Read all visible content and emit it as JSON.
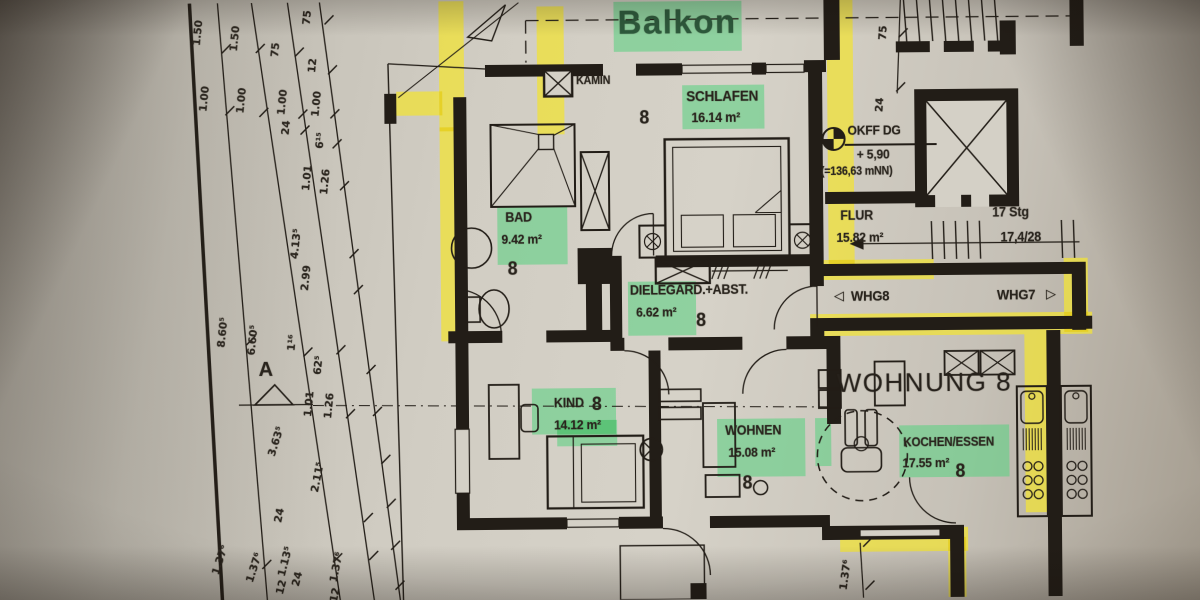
{
  "photo": {
    "kind": "architectural floor plan photo",
    "language": "de"
  },
  "labels": {
    "balkon": "Balkon",
    "kamin": "KAMIN",
    "gard": "GARD.+ABST.",
    "wohnung": "WOHNUNG 8",
    "whg8": "WHG8",
    "whg7": "WHG7",
    "arrow_left": "◁",
    "arrow_right": "▷",
    "level1": "OKFF DG",
    "level2": "+ 5,90",
    "level3": "(=136,63 mNN)",
    "stairs1": "17 Stg",
    "stairs2": "17,4/28",
    "apartment_number": "8",
    "section_marker": "A"
  },
  "rooms": [
    {
      "name": "SCHLAFEN",
      "area": "16.14 m²"
    },
    {
      "name": "BAD",
      "area": "9.42 m²"
    },
    {
      "name": "DIELE",
      "area": "6.62 m²"
    },
    {
      "name": "FLUR",
      "area": "15.82 m²"
    },
    {
      "name": "KIND",
      "area": "14.12 m²"
    },
    {
      "name": "WOHNEN",
      "area": "15.08 m²"
    },
    {
      "name": "KOCHEN/ESSEN",
      "area": "17.55 m²"
    }
  ],
  "dimensions": {
    "left": [
      "1.50",
      "1.00",
      "1.50",
      "1.00",
      "75",
      "1.00",
      "24",
      "75",
      "12",
      "1.00",
      "6¹⁵",
      "1.01",
      "1.26",
      "4.13⁵",
      "2.99",
      "8.60⁵",
      "6.60⁵",
      "1¹⁶",
      "62⁵",
      "1.01",
      "1.26",
      "3.63⁵",
      "2.11⁵",
      "24",
      "1.37⁶",
      "1.37⁶",
      "1.13⁵",
      "12",
      "24",
      "1.37⁶",
      "12"
    ],
    "top_right": [
      "75",
      "24"
    ],
    "bottom_right": [
      "1.37⁶"
    ]
  },
  "colors": {
    "highlight_yellow": "#f0e23c",
    "highlight_green": "#5fd084",
    "ink": "#221d17",
    "balkon_text": "#2d5a3c"
  }
}
